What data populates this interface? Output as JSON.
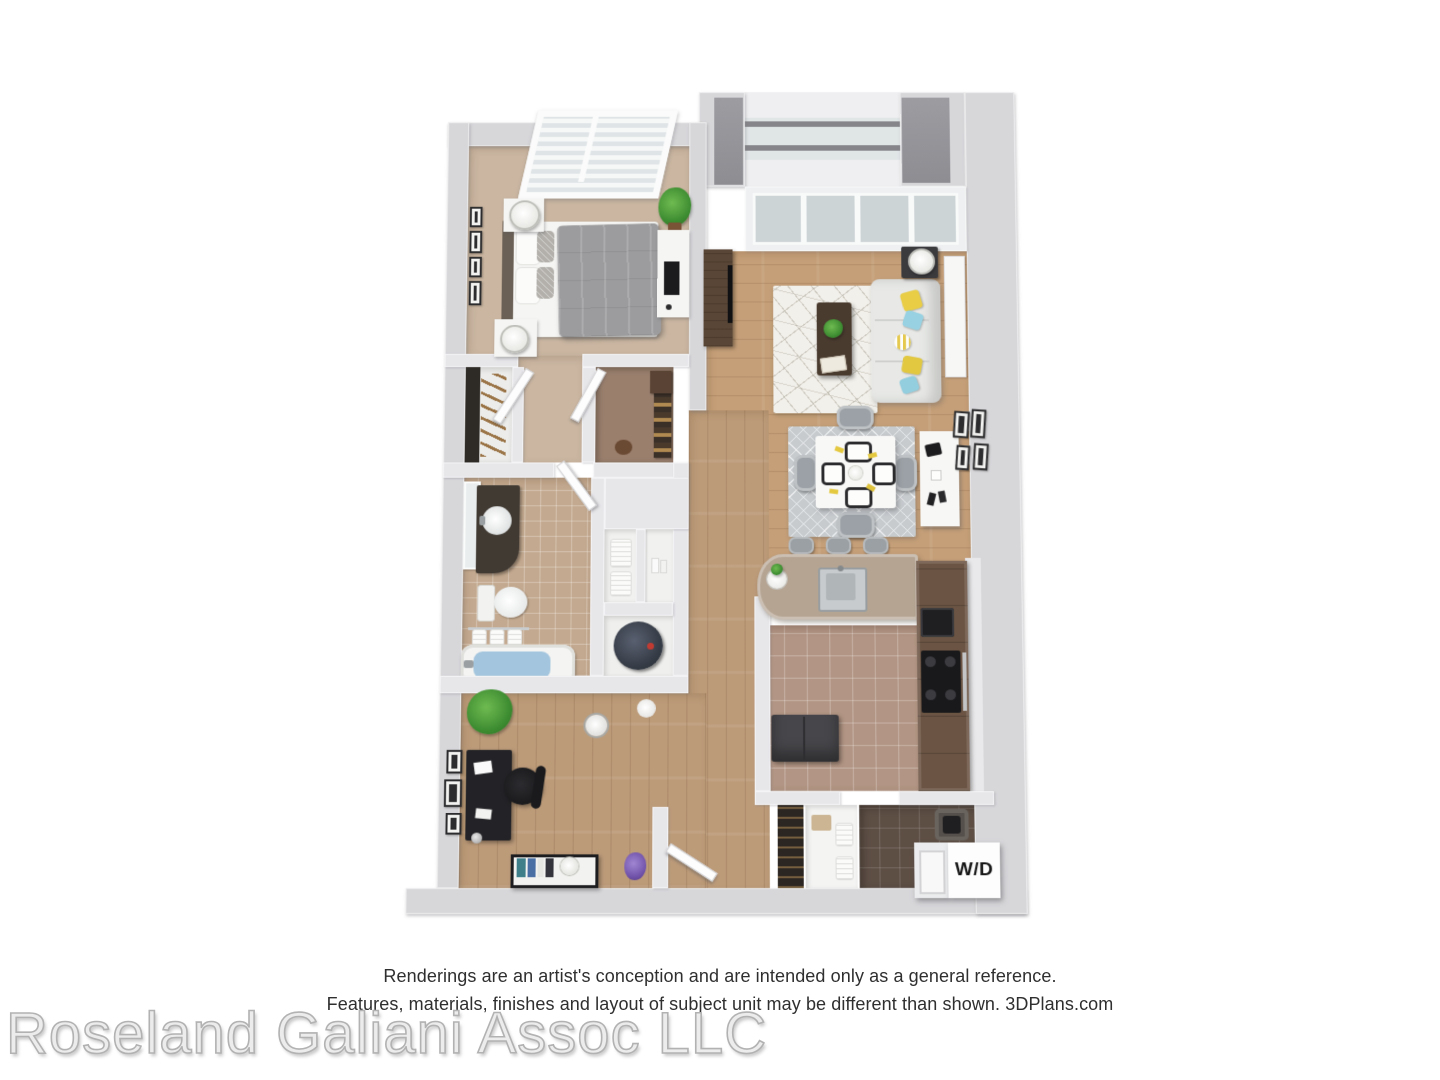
{
  "floorplan": {
    "title": "3D apartment floor plan rendering",
    "washer_dryer_label": "W/D",
    "rooms": [
      "bedroom",
      "reach-in closet",
      "walk-in closet",
      "bathroom",
      "linen closet",
      "water-heater closet",
      "hallway",
      "office den",
      "living room",
      "dining area",
      "kitchen",
      "breakfast bar",
      "laundry room",
      "balcony",
      "entry"
    ],
    "colors": {
      "wall_light": "#d7d7da",
      "wall_face_dark": "#95959a",
      "bedroom_carpet": "#cab6a1",
      "wood_floor": "#c59f78",
      "kitchen_tile": "#b29584",
      "laundry_tile": "#5e4f45",
      "bath_tile": "#c3a98f",
      "cabinet_brown": "#6b5443",
      "counter_taupe": "#b5a492",
      "living_rug": "#f2f0ea",
      "dining_rug": "#c7cbce",
      "sofa": "#e8e9e7",
      "pillow_yellow": "#e8cd45",
      "pillow_blue": "#98d2e2",
      "tub_water": "#a3c6de",
      "plant_green": "#4a9a3c"
    }
  },
  "footer": {
    "disclaimer_line1": "Renderings are an artist's conception and are intended only as a general reference.",
    "disclaimer_line2": "Features, materials, finishes and layout of subject unit may be different than shown. 3DPlans.com",
    "watermark": "Roseland Galiani Assoc LLC"
  }
}
